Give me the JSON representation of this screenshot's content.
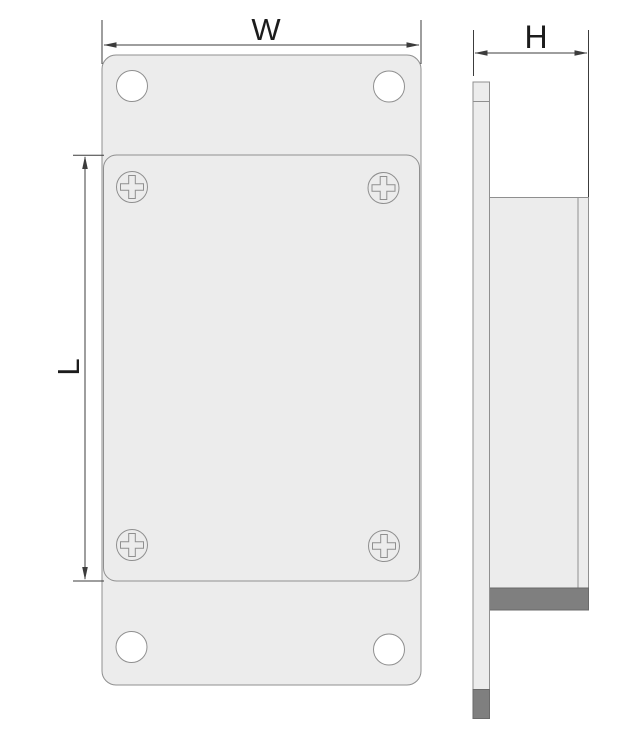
{
  "dimensions": {
    "width_label": "W",
    "height_label": "H",
    "length_label": "L"
  },
  "icons": {
    "screw": "phillips-screw-icon",
    "hole": "mounting-hole",
    "arrow": "dimension-arrowhead-icon"
  },
  "colors": {
    "background": "#ffffff",
    "part_fill": "#ececec",
    "part_outline": "#8f8f8f",
    "dark_fill": "#7f7f7f",
    "dark_outline": "#6a6a6a",
    "dimension_line": "#3c3c3c",
    "label_text": "#1c1c1c",
    "hole_fill": "#ffffff"
  }
}
